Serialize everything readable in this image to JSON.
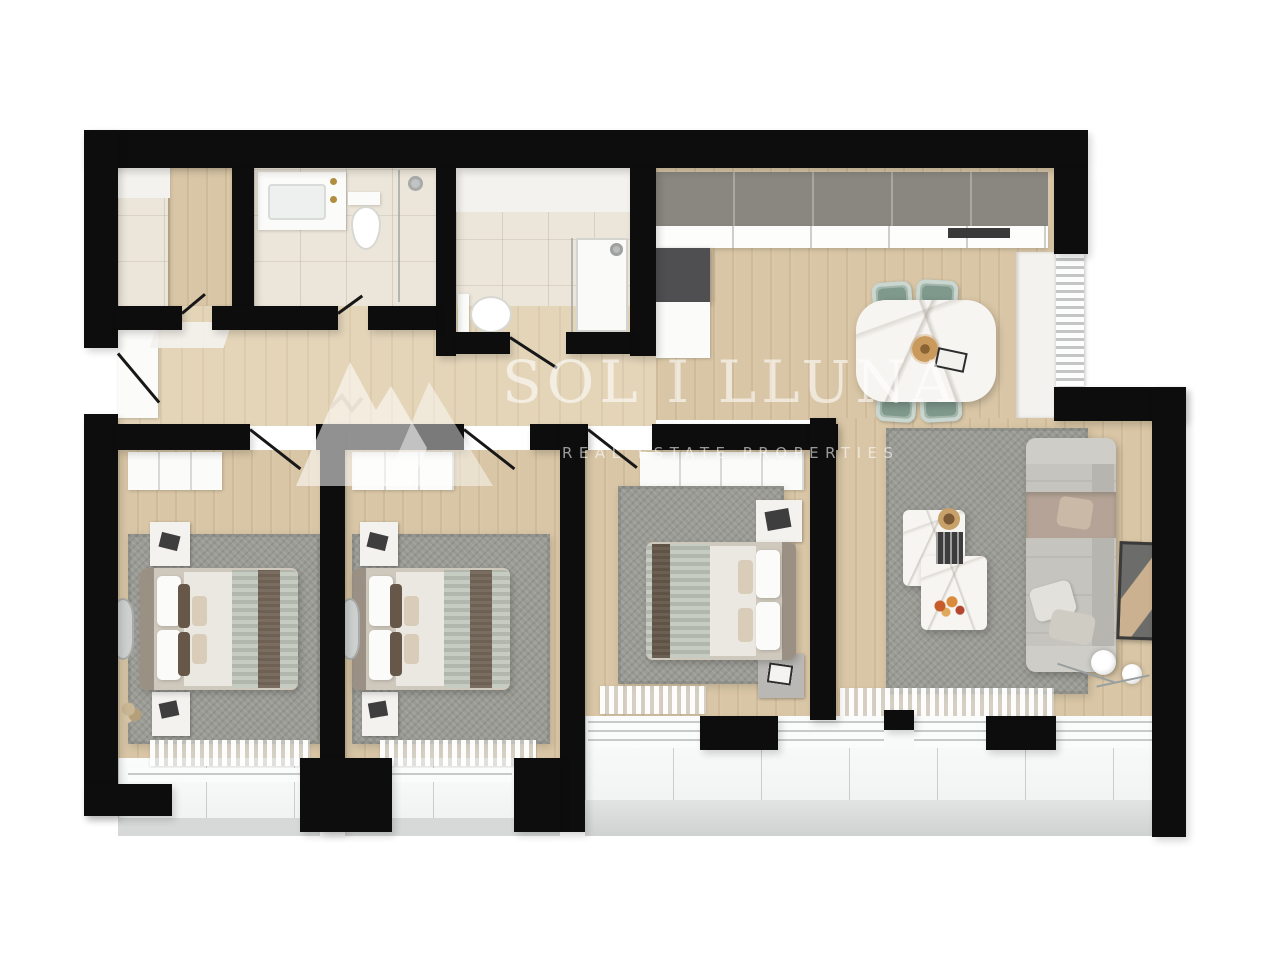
{
  "watermark": {
    "title": "SOL I LLUNA",
    "subtitle": "REAL ESTATE PROPERTIES",
    "logo_icon": "mountains-icon"
  },
  "palette": {
    "wall": "#0d0d0d",
    "wood": "#d9c6a6",
    "wood_light": "#e4d5b9",
    "tile": "#ece6da",
    "terrace": "#f4f5f6",
    "rug": "#9b9b95",
    "marble": "#f7f5f1",
    "cabinet": "#8a8680",
    "fridge": "#4f4f51",
    "chair": "#a3b6ab",
    "chair_dark": "#7f998c",
    "sofa": "#c6c4bf",
    "sofa_trim": "#cfcdc8",
    "blanket": "#b4a396",
    "bed_blanket_a": "#c6ccc2",
    "bed_blanket_b": "#b1b7ad",
    "headboard": "#9a9083",
    "throw": "#6e6052",
    "watermark": "rgba(255,255,255,0.58)"
  }
}
